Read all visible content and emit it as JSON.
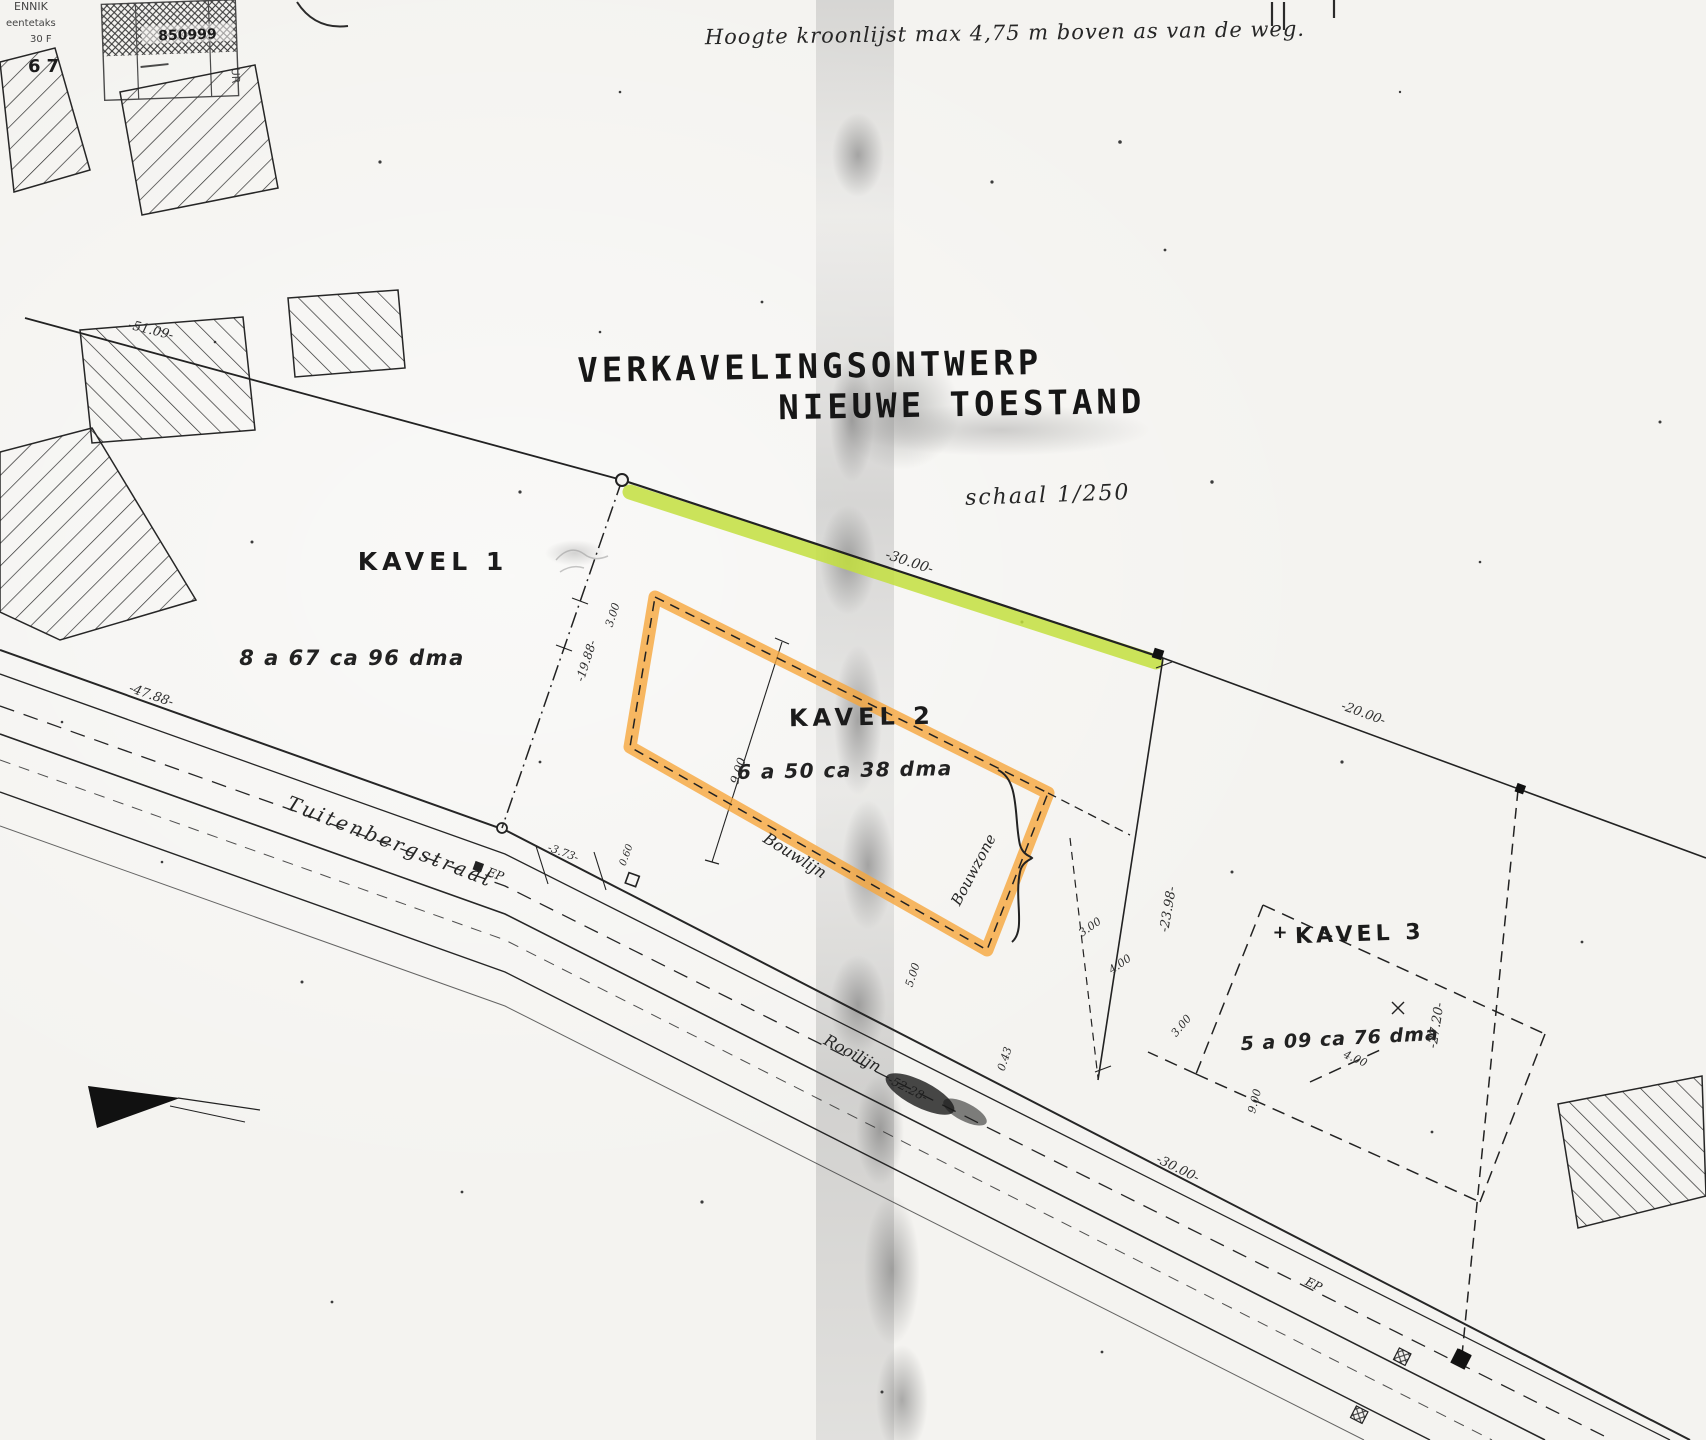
{
  "document": {
    "note_top": "Hoogte  kroonlijst   max 4,75 m  boven   as  van de weg.",
    "title_line1": "VERKAVELINGSONTWERP",
    "title_line2": "NIEUWE TOESTAND",
    "scale": "schaal 1/250"
  },
  "stamp": {
    "number": "850999",
    "side_text": "UR",
    "fragment_1": "ENNIK",
    "fragment_2": "eentetaks",
    "fragment_3": "30 F",
    "fragment_4": "67"
  },
  "parcels": {
    "kavel1": {
      "name": "KAVEL 1",
      "area": "8 a 67 ca 96 dma"
    },
    "kavel2": {
      "name": "KAVEL 2",
      "area": "6 a 50 ca 38 dma"
    },
    "kavel3": {
      "name": "KAVEL 3",
      "area": "5 a 09 ca 76 dma",
      "plus_mark": "+"
    }
  },
  "road": {
    "name": "Tuitenbergstraat",
    "ep1": "EP",
    "ep2": "EP"
  },
  "line_labels": {
    "bouwlijn": "Bouwlijn",
    "rooilijn": "Rooilijn",
    "bouwzone": "Bouwzone"
  },
  "dimensions": {
    "d51_09": "-51.09-",
    "d47_88": "-47.88-",
    "d30_00": "-30.00-",
    "d20_00": "-20.00-",
    "d19_88": "-19.88-",
    "d3_00a": "3.00",
    "d9_00a": "9.00",
    "d23_98": "-23.98-",
    "d4_00a": "4.00",
    "d3_00b": "3.00",
    "d5_00": "5.00",
    "d0_43": "0.43",
    "d3_73": "-3.73-",
    "d0_60": "0.60",
    "d52_28": "-52.28-",
    "d30_00b": "-30.00-",
    "d27_20": "-27.20-",
    "d3_00c": "3.00",
    "d9_00b": "9.00",
    "d4_00b": "4.00"
  },
  "colors": {
    "highlight_green": "#c3df3e",
    "highlight_orange": "#f6a63c",
    "ink": "#222222",
    "paper": "#f4f3f0"
  }
}
